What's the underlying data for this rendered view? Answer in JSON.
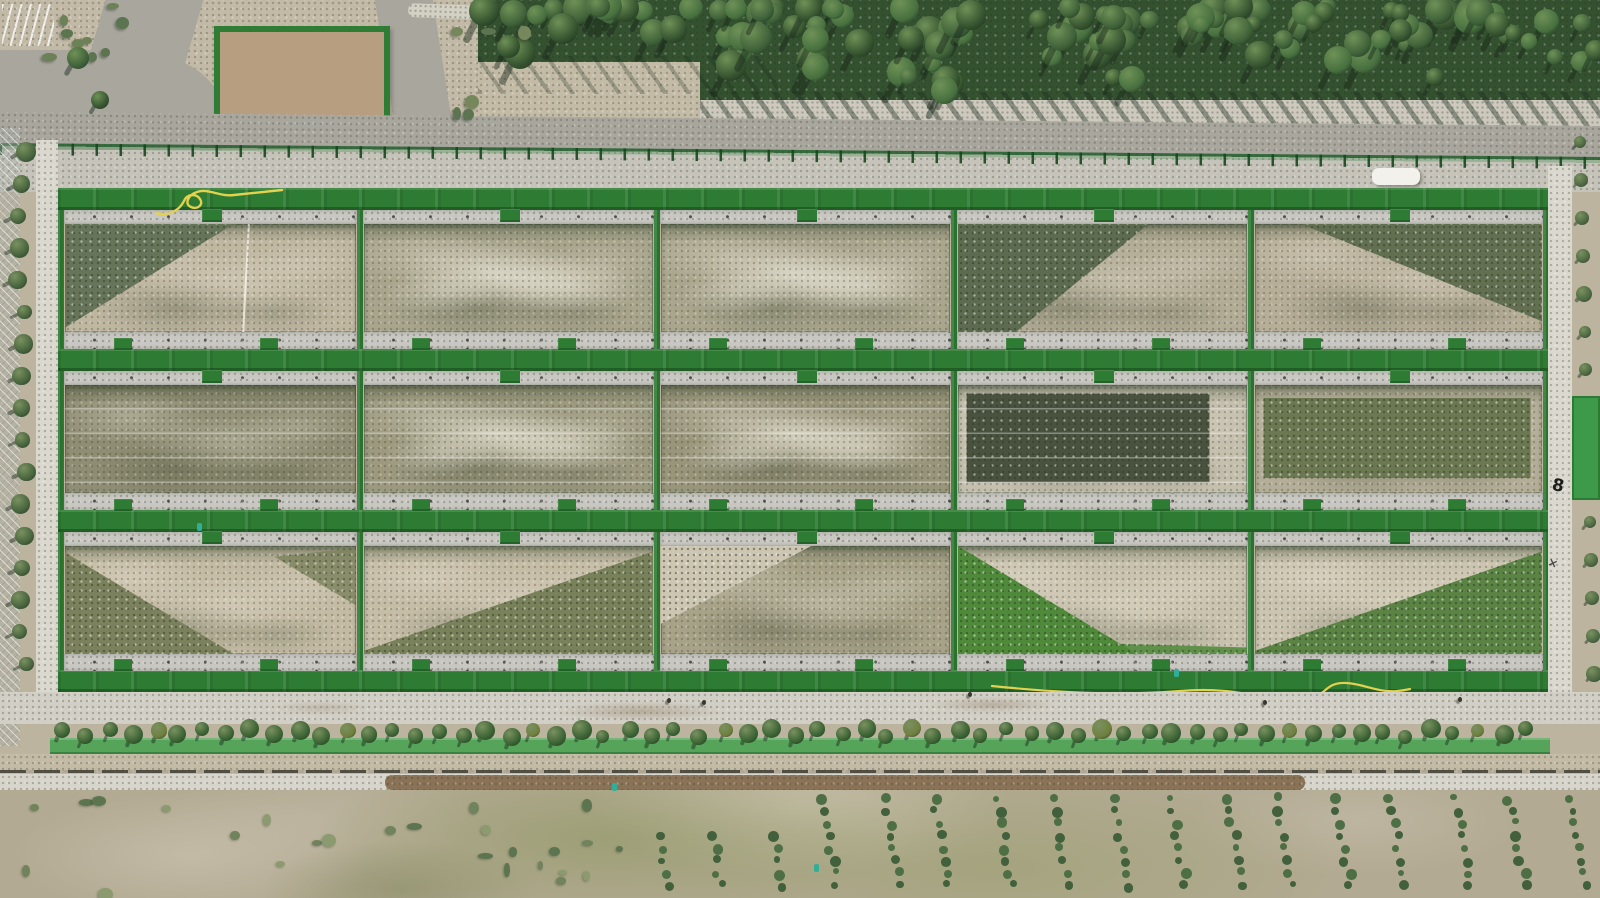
{
  "meta": {
    "description": "Aerial drone view of fenced experimental re-vegetation field plots between a poplar forest belt and scrubland",
    "width": 1600,
    "height": 898
  },
  "palette": {
    "bar_green": "#2e7b33",
    "gravel": "#c8c7c1",
    "road_top": "#a9a69e",
    "road_bottom": "#d6d3ca",
    "dirt_base": "#bdb49f",
    "pavers": "#cfccc0",
    "fence_green": "#2f7c35",
    "forest_dark": "#2c452e",
    "scrub_grass": "#97a06c",
    "bush_green": "#5c7450",
    "conifer_green": "#42603c",
    "tree_row_green": "#3a6233",
    "mesh_strip_green": "#44a04e",
    "hose_yellow": "#e3d14f",
    "enclosure_dirt": "#b79e81",
    "tilled_soil": "#8a7257",
    "marker_teal": "#2fae9a",
    "car_white": "#f2f1ec"
  },
  "path_marks": {
    "figure_eight": "8",
    "cross": "×"
  },
  "field_grid": {
    "left": 57,
    "top": 188,
    "width": 1493,
    "height": 504,
    "bar_h": 22,
    "bar_ys": [
      0,
      161,
      322,
      482
    ],
    "row_tops": [
      22,
      183,
      344
    ],
    "row_h": 139,
    "gravel_top_h": 14,
    "gravel_bottom_h": 17,
    "cols": [
      [
        7,
        293
      ],
      [
        306,
        291
      ],
      [
        603,
        291
      ],
      [
        900,
        291
      ],
      [
        1197,
        289
      ]
    ],
    "dividers": [
      300,
      597,
      894,
      1191
    ],
    "plots": [
      {
        "id": "plot-r1c1",
        "base": "#c0b7a1",
        "green": "#66755a",
        "pattern": "greenUL",
        "extras": [
          "whiteline"
        ]
      },
      {
        "id": "plot-r1c2",
        "base": "#a9a58d",
        "green": "#6d765a",
        "pattern": "plain",
        "extras": [
          "pale"
        ]
      },
      {
        "id": "plot-r1c3",
        "base": "#aaa68e",
        "green": "#6d765a",
        "pattern": "plain",
        "extras": [
          "pale"
        ]
      },
      {
        "id": "plot-r1c4",
        "base": "#b3ac96",
        "green": "#5d6b50",
        "pattern": "greenUL2",
        "extras": []
      },
      {
        "id": "plot-r1c5",
        "base": "#b7ae98",
        "green": "#626f51",
        "pattern": "greenTR",
        "extras": []
      },
      {
        "id": "plot-r2c1",
        "base": "#8f8d73",
        "green": "#6d765a",
        "pattern": "plain",
        "extras": [
          "lines"
        ]
      },
      {
        "id": "plot-r2c2",
        "base": "#9c997f",
        "green": "#6d765a",
        "pattern": "plain",
        "extras": [
          "pale",
          "lines"
        ]
      },
      {
        "id": "plot-r2c3",
        "base": "#99957b",
        "green": "#6d765a",
        "pattern": "plain",
        "extras": [
          "pale",
          "lines"
        ]
      },
      {
        "id": "plot-r2c4",
        "base": "#c5bfae",
        "green": "#49523e",
        "pattern": "darkPatch",
        "extras": [
          "lines"
        ]
      },
      {
        "id": "plot-r2c5",
        "base": "#b4ad97",
        "green": "#6b7852",
        "pattern": "oliveBand",
        "extras": []
      },
      {
        "id": "plot-r3c1",
        "base": "#c4bba4",
        "green": "#7b815c",
        "pattern": "vSplit",
        "extras": []
      },
      {
        "id": "plot-r3c2",
        "base": "#c6bda7",
        "green": "#78815a",
        "pattern": "greenLR",
        "extras": []
      },
      {
        "id": "plot-r3c3",
        "base": "#a7a288",
        "green": "#9aa07b",
        "accent": "#cdc6b2",
        "pattern": "paleTL",
        "extras": []
      },
      {
        "id": "plot-r3c4",
        "base": "#c9c2ae",
        "green": "#4f8a3a",
        "pattern": "greenLL",
        "extras": []
      },
      {
        "id": "plot-r3c5",
        "base": "#cbc4b0",
        "green": "#5a8344",
        "pattern": "greenLR",
        "extras": []
      }
    ]
  },
  "forest": {
    "bands": [
      {
        "x": 478,
        "y": 0,
        "w": 300,
        "h": 62,
        "count": 28
      },
      {
        "x": 700,
        "y": 0,
        "w": 900,
        "h": 104,
        "count": 95
      }
    ],
    "canopy_colors": [
      "#3f6139",
      "#35532f",
      "#47703f"
    ],
    "highlight": "#6f9157"
  },
  "tree_row": {
    "count": 63,
    "start_x": 62,
    "spacing": 23.6,
    "y": 728
  },
  "left_tree_column": {
    "count": 17,
    "x": 22,
    "start_y": 152,
    "spacing": 32
  },
  "right_shrub_column": {
    "count": 15,
    "x": 1580,
    "start_y": 142,
    "spacing": 38
  },
  "plantation": {
    "cols": 17,
    "start_x": 646,
    "col_spacing": 57,
    "rows": 9,
    "row_spacing": 12.5,
    "tilt": 2.2
  },
  "bushes": {
    "count": 26
  },
  "hoses": {
    "top": {
      "x": 150,
      "y": 183,
      "w": 140,
      "h": 40
    },
    "bottom": {
      "x": 990,
      "y": 672,
      "w": 430,
      "h": 34
    }
  },
  "markers": {
    "teal": [
      [
        197,
        523
      ],
      [
        612,
        783
      ],
      [
        814,
        864
      ],
      [
        1174,
        669
      ]
    ],
    "people": [
      [
        667,
        698
      ],
      [
        702,
        700
      ],
      [
        968,
        692
      ],
      [
        1263,
        700
      ],
      [
        1458,
        697
      ]
    ]
  },
  "white_vehicle": {
    "x": 1372,
    "y": 168,
    "w": 48,
    "h": 17
  },
  "enclosure": {
    "x": 214,
    "y": 26,
    "w": 176,
    "h": 120
  },
  "green_square": {
    "x": 1572,
    "y": 396,
    "w": 28,
    "h": 104
  }
}
